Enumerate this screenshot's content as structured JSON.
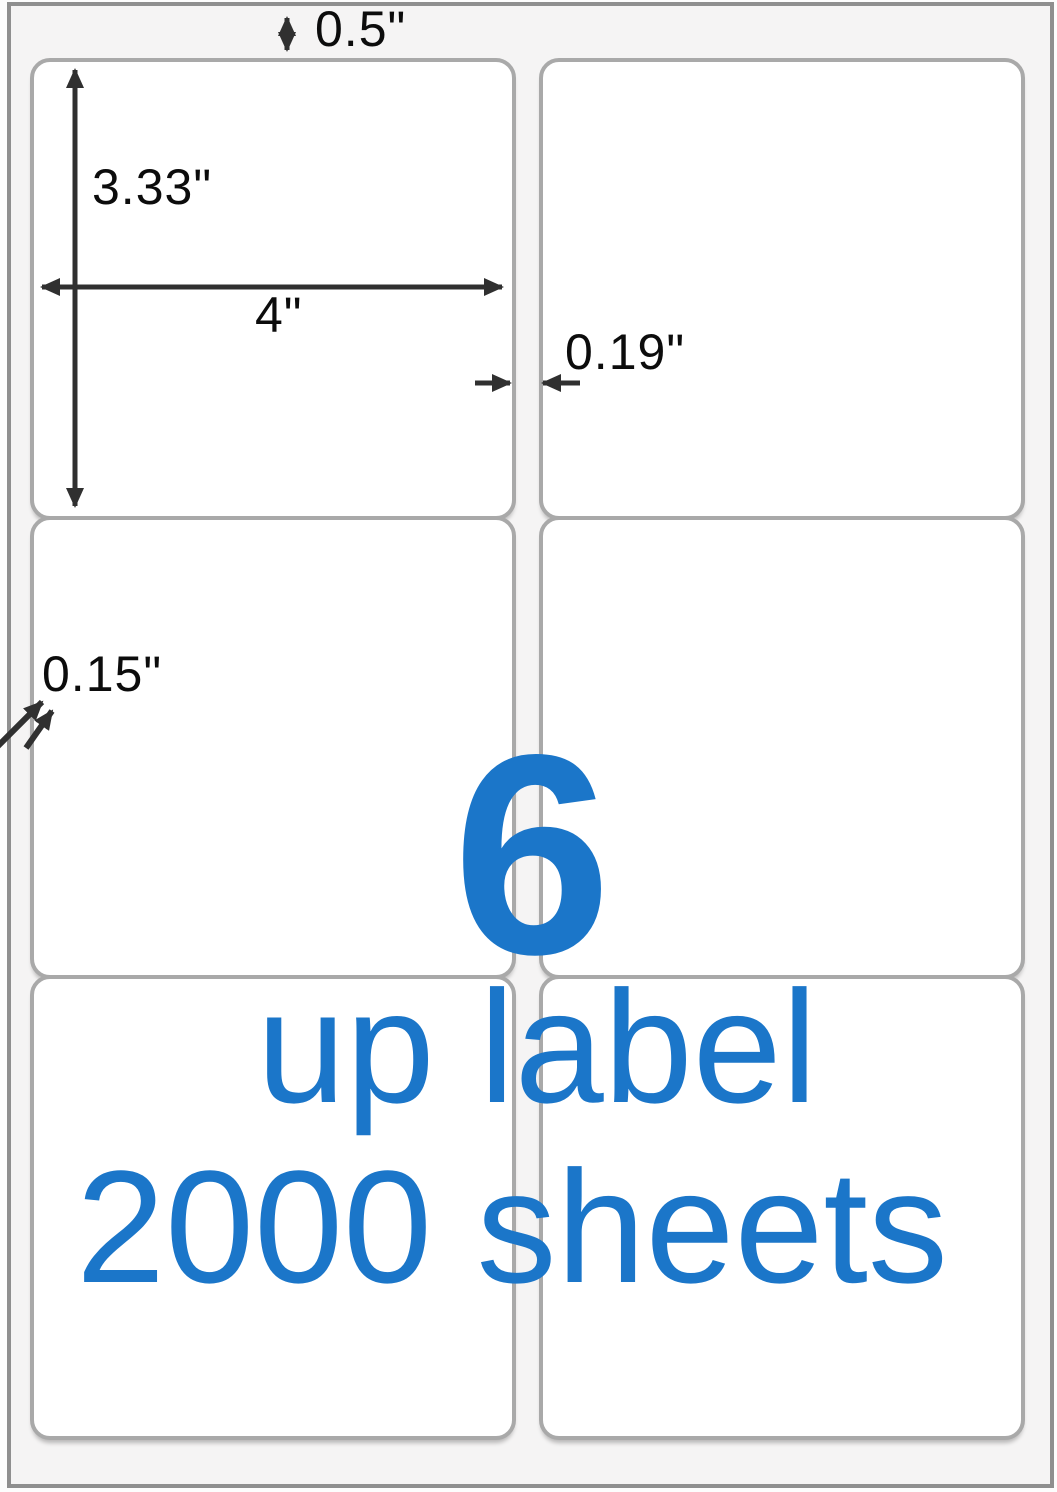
{
  "annotations": {
    "top_margin": "0.5\"",
    "label_height": "3.33\"",
    "label_width": "4\"",
    "column_gap": "0.19\"",
    "edge_margin": "0.15\""
  },
  "overlay": {
    "count": "6",
    "caption_line1": "up label",
    "caption_line2": "2000 sheets"
  },
  "layout": {
    "labels_per_sheet": 6,
    "columns": 2,
    "rows": 3
  },
  "colors": {
    "accent_blue": "#1b76c9",
    "arrow_gray": "#303030",
    "label_border": "#a9a9a9",
    "sheet_background": "#f5f4f4"
  }
}
